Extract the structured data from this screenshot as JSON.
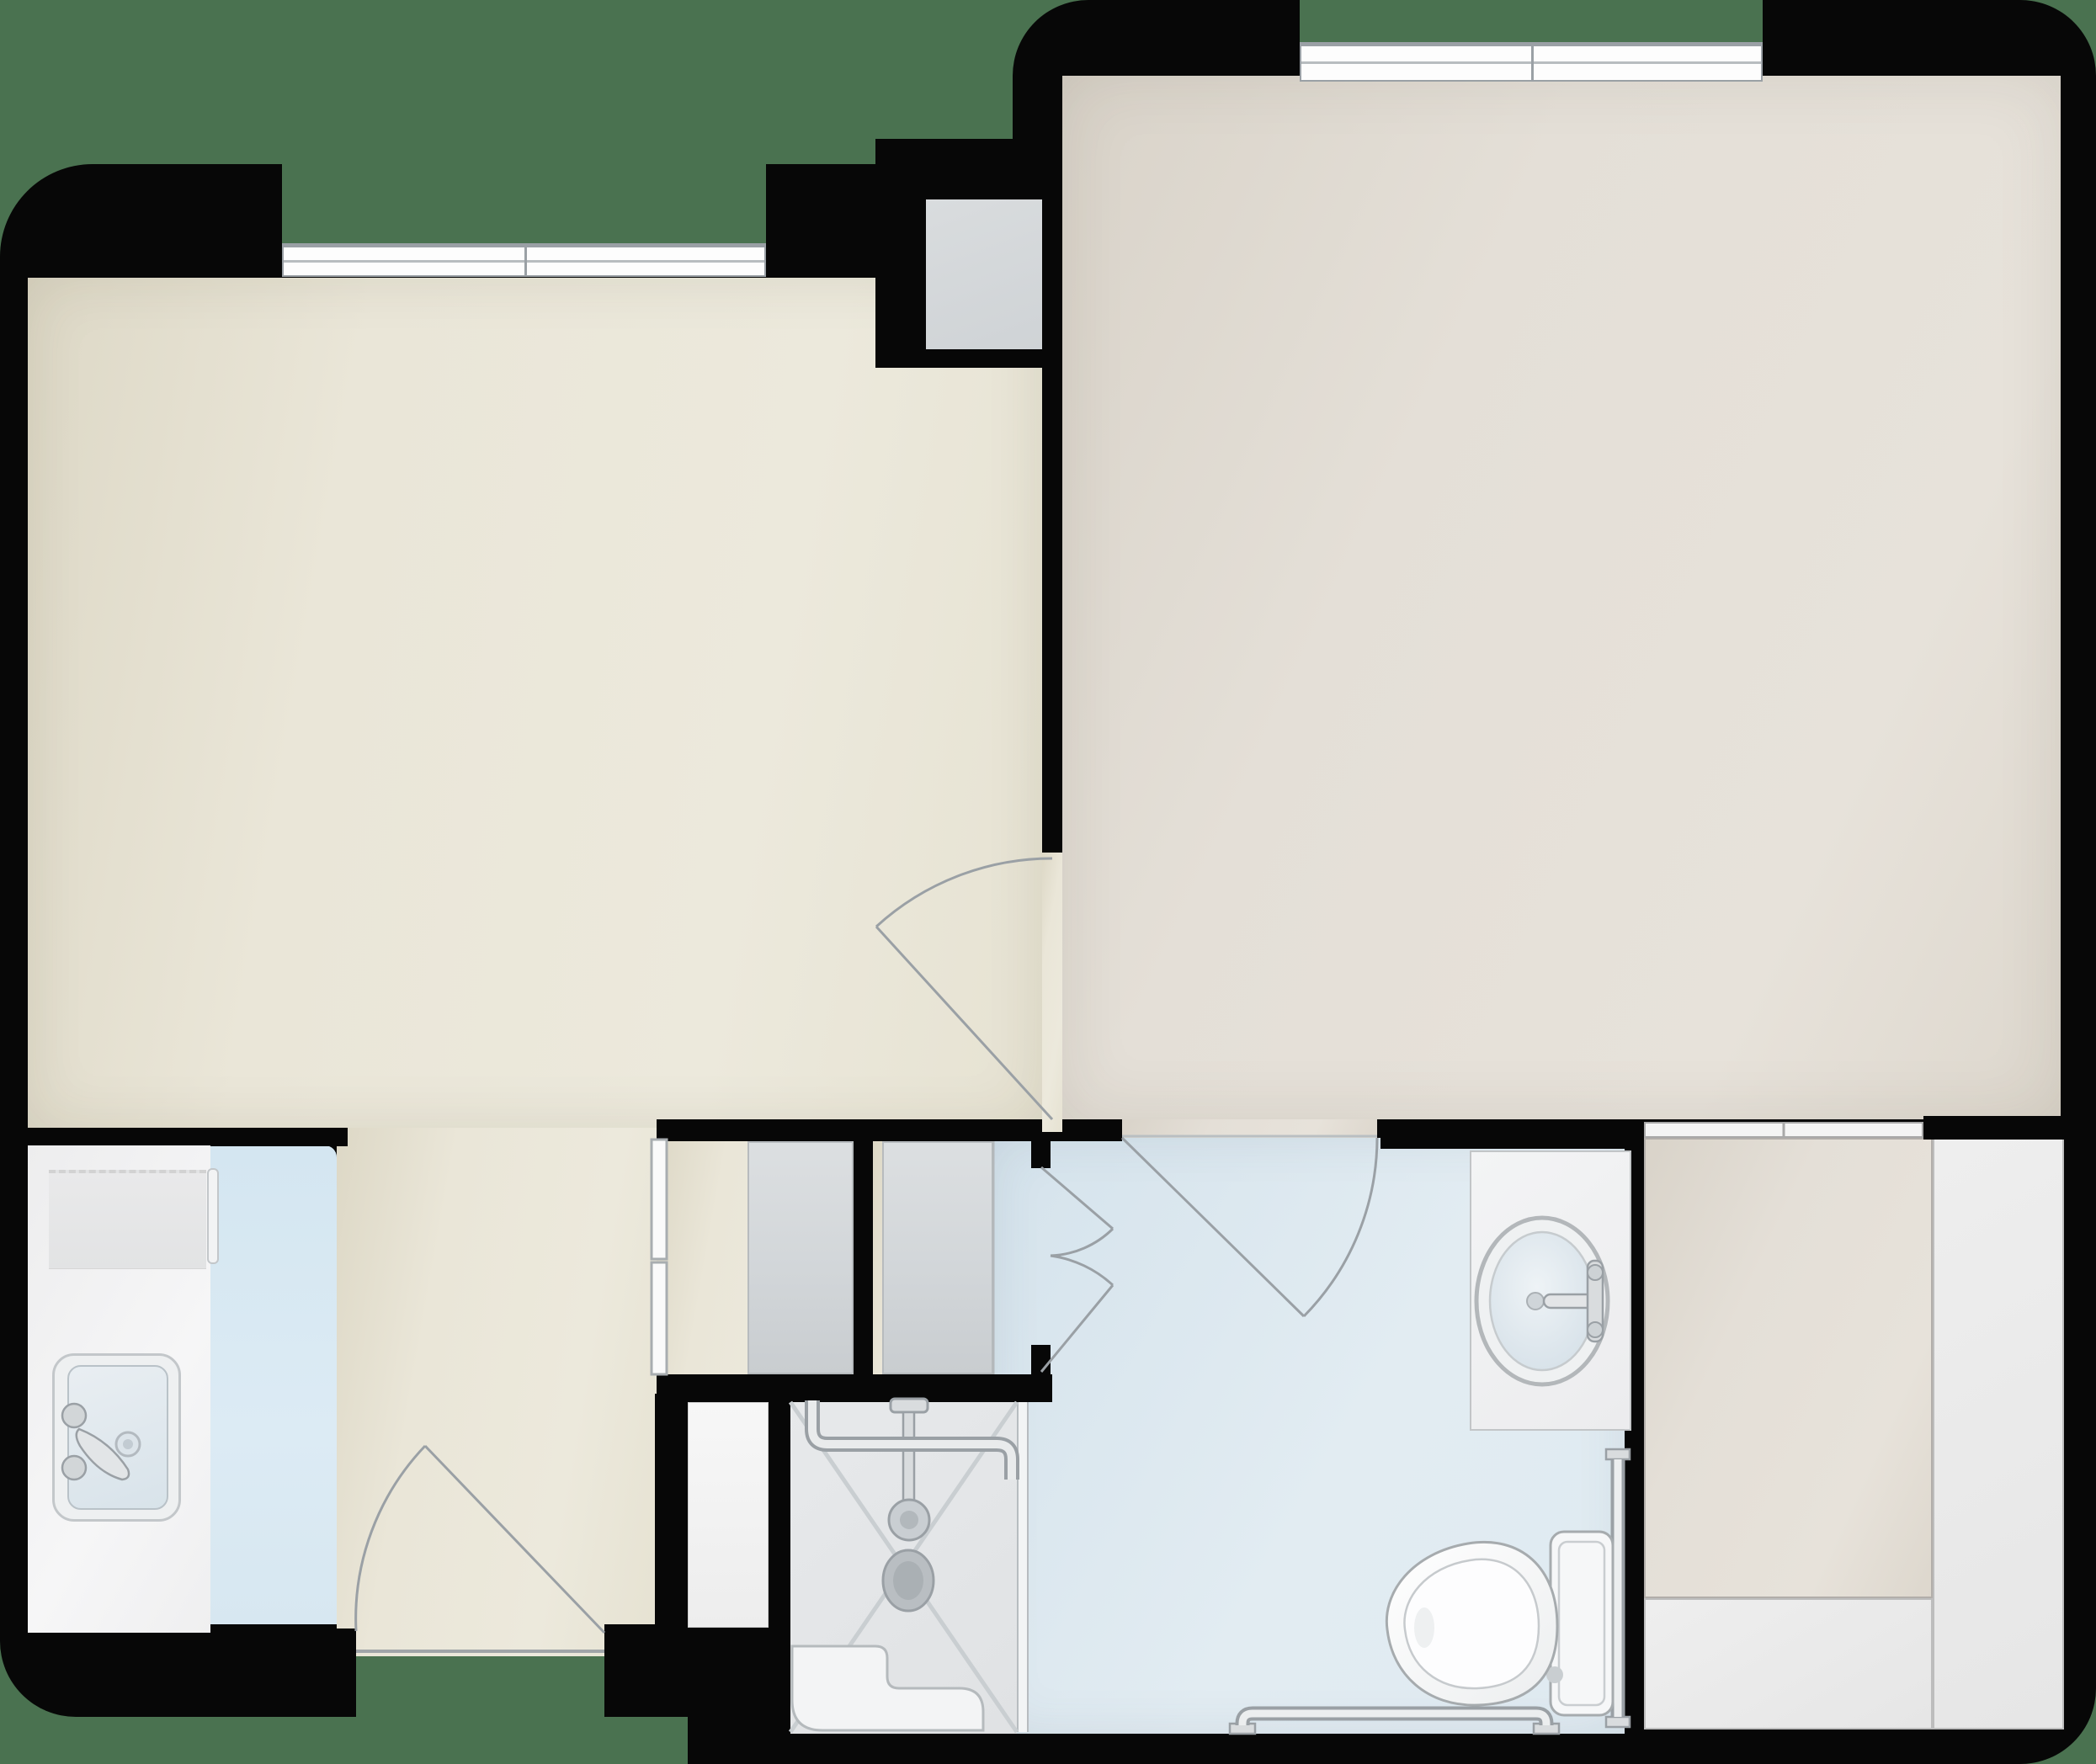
{
  "title": "One-bedroom apartment floor plan (top-down architectural rendering, no text labels)",
  "colors": {
    "bg-green": "#4a7250",
    "wall-black": "#070707",
    "room-cream": "#eae6d8",
    "room-greige": "#e4dfd7",
    "floor-blue": "#dfeaf1",
    "floor-blue-kitchen": "#d9e8f2",
    "floor-gray": "#d5d8da",
    "floor-shower": "#e5e7e9",
    "white-area": "#ebebeb",
    "fixture-white": "#f5f6f7",
    "fixture-stroke": "#a6abaf",
    "line-gray": "#9aa0a5",
    "glass-line": "#c9ced2"
  },
  "rooms": [
    {
      "id": "living-room",
      "floor": "cream",
      "features": [
        "window-top",
        "entry-door-bottom",
        "open-corridor"
      ]
    },
    {
      "id": "bedroom",
      "floor": "greige",
      "features": [
        "window-top",
        "door-to-living",
        "door-to-bathroom",
        "cased-opening-to-extension"
      ]
    },
    {
      "id": "kitchen-nook",
      "floor": "blue",
      "fixtures": [
        "counter",
        "cooktop",
        "double-knob-sink"
      ]
    },
    {
      "id": "bathroom",
      "floor": "blue",
      "fixtures": [
        "vanity-round-sink",
        "toilet",
        "grab-bars",
        "roll-in-shower"
      ]
    },
    {
      "id": "shower",
      "floor": "gray-tile",
      "fixtures": [
        "drain",
        "shower-head",
        "grab-bar",
        "fold-seat"
      ]
    },
    {
      "id": "closet-pair",
      "floor": "cream",
      "features": [
        "sliding-doors",
        "gray-door-panels"
      ]
    },
    {
      "id": "top-closet",
      "floor": "gray"
    },
    {
      "id": "extension-room",
      "floor": "greige"
    },
    {
      "id": "white-wrap-area",
      "floor": "white"
    }
  ],
  "doors": [
    {
      "id": "entry-door",
      "type": "single-swing",
      "location": "bottom-of-corridor"
    },
    {
      "id": "living-bedroom-door",
      "type": "single-swing",
      "location": "center-wall"
    },
    {
      "id": "bedroom-bathroom-door",
      "type": "single-swing",
      "location": "bathroom-top-wall"
    },
    {
      "id": "bathroom-double-doors",
      "type": "double-swing",
      "location": "bathroom-entry"
    }
  ],
  "windows": [
    {
      "id": "living-window",
      "wall": "top-left"
    },
    {
      "id": "bedroom-window",
      "wall": "top-right"
    }
  ]
}
